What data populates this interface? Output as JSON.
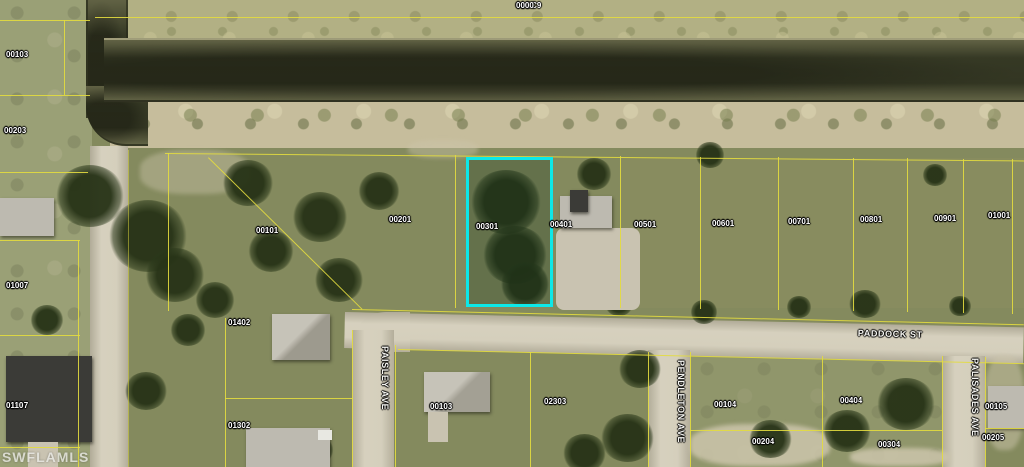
{
  "map": {
    "watermark": "SWFLAMLS",
    "region_label": {
      "block": "01GC9",
      "lot": "0000"
    },
    "highlight": {
      "parcel_block": "01001",
      "parcel_lot": "0030",
      "color": "#0de8e8"
    },
    "colors": {
      "parcel_line": "#e3dc3f",
      "water": "#4a4e33",
      "street": "#cbc5b2",
      "highlight": "#0de8e8"
    },
    "streets": [
      {
        "name": "PADDOCK ST"
      },
      {
        "name": "PAISLEY AVE"
      },
      {
        "name": "PENDLETON AVE"
      },
      {
        "name": "PALISADES AVE"
      }
    ],
    "parcels": [
      {
        "block": "01093",
        "lot": "0010"
      },
      {
        "block": "01093",
        "lot": "0020"
      },
      {
        "block": "01097",
        "lot": "0100"
      },
      {
        "block": "01097",
        "lot": "0110"
      },
      {
        "block": "01001",
        "lot": "0010"
      },
      {
        "block": "01001",
        "lot": "0020"
      },
      {
        "block": "01001",
        "lot": "0030",
        "highlighted": true
      },
      {
        "block": "01001",
        "lot": "0040"
      },
      {
        "block": "01001",
        "lot": "0050"
      },
      {
        "block": "01001",
        "lot": "0060"
      },
      {
        "block": "01001",
        "lot": "0070"
      },
      {
        "block": "01001",
        "lot": "0080"
      },
      {
        "block": "01001",
        "lot": "0090"
      },
      {
        "block": "01001",
        "lot": "0100"
      },
      {
        "block": "01002",
        "lot": "0140"
      },
      {
        "block": "01002",
        "lot": "0130"
      },
      {
        "block": "01003",
        "lot": "0010"
      },
      {
        "block": "01003",
        "lot": "0230"
      },
      {
        "block": "01004",
        "lot": "0010"
      },
      {
        "block": "01004",
        "lot": "0040"
      },
      {
        "block": "01004",
        "lot": "0020"
      },
      {
        "block": "01004",
        "lot": "0030"
      },
      {
        "block": "01005",
        "lot": "0010"
      },
      {
        "block": "01005",
        "lot": "0020"
      }
    ]
  }
}
